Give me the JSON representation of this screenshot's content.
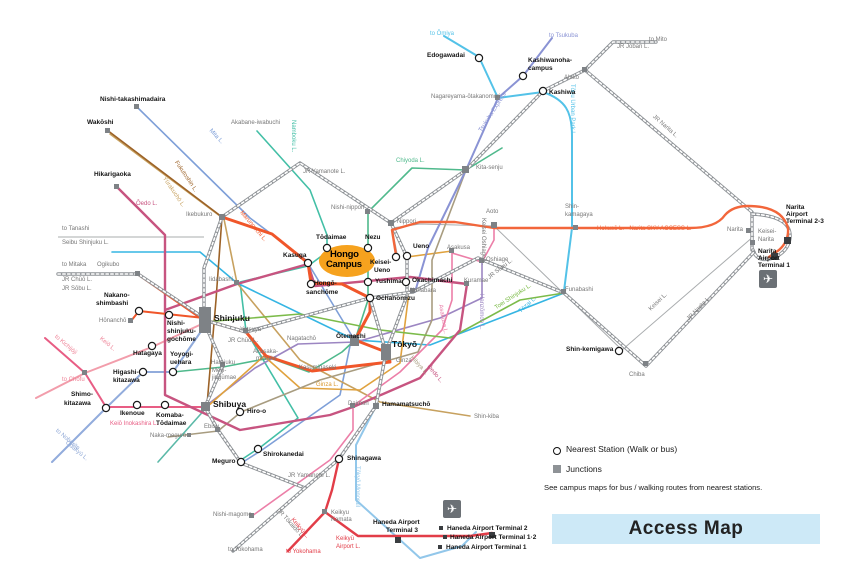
{
  "colors": {
    "jr_rail": "#8E9296",
    "marunouchi": "#F0562A",
    "ginza": "#E0A23E",
    "hibiya": "#A89C80",
    "chiyoda": "#4FB98C",
    "namboku": "#43BFA6",
    "mita": "#7E9FD8",
    "oedo": "#C75480",
    "tozai": "#35B5E3",
    "yurakucho": "#C7A15F",
    "fukutoshin": "#9C6227",
    "hanzomon": "#9C86C2",
    "asakusa_line": "#EC7FA8",
    "toei_shinjuku": "#7CBB4A",
    "keio": "#F29DAB",
    "inokashira": "#E85D84",
    "odakyu": "#92ACDC",
    "keikyu": "#E23D48",
    "monorail": "#92C7EA",
    "tobu_urban_park": "#53C2E8",
    "tsukuba_express": "#8A93D4",
    "hokuso_sky_access": "#F2663B",
    "keisei": "#A9ACAE",
    "denentoshi": "#5BB9A8",
    "campus_highlight": "#F6A21E",
    "title_bg": "#CDE9F7"
  },
  "campus": {
    "line1": "Hongo",
    "line2": "Campus"
  },
  "legend": {
    "nearest_station": "Nearest Station (Walk or bus)",
    "junctions": "Junctions",
    "note": "See campus maps for bus / walking routes from nearest stations.",
    "title": "Access Map"
  },
  "stations": {
    "wakoshi": "Wakōshi",
    "nishi_takashimadaira": "Nishi-takashimadaira",
    "hikarigaoka": "Hikarigaoka",
    "akabane_iwabuchi": "Akabane-iwabuchi",
    "edogawadai": "Edogawadai",
    "kashiwanoha_a": "Kashiwanoha-",
    "kashiwanoha_b": "campus",
    "kashiwa": "Kashiwa",
    "abiko": "Abiko",
    "nagareyama": "Nagareyama-ōtakanomori",
    "kita_senju": "Kita-senju",
    "nishi_nippori": "Nishi-nippori",
    "nippori": "Nippori",
    "ikebukuro": "Ikebukuro",
    "ogikubo": "Ogikubo",
    "yotsuya": "Yotsuya",
    "iidabashi": "Iidabashi",
    "nakano_shimbashi_a": "Nakano-",
    "nakano_shimbashi_b": "shimbashi",
    "honancho": "Hōnanchō",
    "nishi_shinjuku_a": "Nishi-",
    "nishi_shinjuku_b": "shinjuku-",
    "nishi_shinjuku_c": "gochōme",
    "shinjuku": "Shinjuku",
    "hatagaya": "Hatagaya",
    "yoyogi_a": "Yoyogi-",
    "yoyogi_b": "uehara",
    "higashi_a": "Higashi-",
    "higashi_b": "kitazawa",
    "shimo_a": "Shimo-",
    "shimo_b": "kitazawa",
    "ikenoue": "Ikenoue",
    "komaba_a": "Komaba-",
    "komaba_b": "Tōdaimae",
    "harajuku": "Harajuku",
    "meiji_a": "Meiji-",
    "meiji_b": "jingūmae",
    "shibuya": "Shibuya",
    "hiro_o": "Hiro-o",
    "ebisu": "Ebisu",
    "naka_meguro": "Naka-meguro",
    "meguro": "Meguro",
    "shirokanedai": "Shirokanedai",
    "shinagawa": "Shinagawa",
    "nishi_magome": "Nishi-magome",
    "keikyu_kamata_a": "Keikyu",
    "keikyu_kamata_b": "Kamata",
    "todaimae": "Tōdaimae",
    "nezu": "Nezu",
    "kasuga": "Kasuga",
    "hongo_sanchome_a": "Hongō-",
    "hongo_sanchome_b": "sanchōme",
    "yushima": "Yushima",
    "ochanomizu": "Ochanomizu",
    "keisei_ueno_a": "Keisei-",
    "keisei_ueno_b": "Ueno",
    "ueno": "Ueno",
    "okachimachi": "Okachimachi",
    "akihabara": "Akihabara",
    "asakusa": "Asakusa",
    "oshiage": "Oshiage",
    "kuramae": "Kuramae",
    "nagatacho": "Nagatachō",
    "akasaka_a": "Akasaka-",
    "akasaka_b": "mitsuke",
    "kasumigaseki": "Kasumigaseki",
    "otemachi": "Ōtemachi",
    "tokyo": "Tōkyō",
    "ginza": "Ginza",
    "daimon": "Daimon",
    "hamamatsucho": "Hamamatsuchō",
    "shin_kiba": "Shin-kiba",
    "aoto": "Aoto",
    "shin_kamagaya_a": "Shin-",
    "shin_kamagaya_b": "kamagaya",
    "funabashi": "Funabashi",
    "narita": "Narita",
    "keisei_narita_a": "Keisei-",
    "keisei_narita_b": "Narita",
    "shin_kemigawa": "Shin-kemigawa",
    "chiba": "Chiba"
  },
  "lines": {
    "jr_yamanote": "JR Yamanote L.",
    "jr_chuo": "JR Chūō L.",
    "jr_sobu": "JR Sōbu L.",
    "seibu_shinjuku": "Seibu Shinjuku L.",
    "jr_joban": "JR Joban L.",
    "jr_narita": "JR Narita L.",
    "jr_tokaido": "JR Tōkaidō L.",
    "mita": "Mita L.",
    "namboku": "Namboku L.",
    "chiyoda": "Chiyoda L.",
    "oedo": "Ōedo L.",
    "fukutoshin": "Fukutoshin L.",
    "yurakucho": "Yūrakuchō L.",
    "marunouchi": "Marunouchi L.",
    "tozai": "Tōzai L.",
    "ginza": "Ginza L.",
    "hibiya": "Hibiya L.",
    "hanzomon": "Hanzōmon L.",
    "asakusa": "Asakusa L.",
    "toei_shinjuku": "Toei Shinjuku L.",
    "keisei_oshiage": "Keisei Oshiage L.",
    "keisei": "Keisei L.",
    "keio": "Keiō L.",
    "keio_inokashira": "Keiō Inokashira L.",
    "odakyu": "Odakyū L.",
    "keikyu": "Keikyū L.",
    "keikyu_airport_a": "Keikyū",
    "keikyu_airport_b": "Airport L.",
    "monorail": "Tōkyō Monorail",
    "tobu": "Tōbu Urban Park L.",
    "tx": "Tsukuba Express",
    "hokuso": "Hokusō L. · Narita SKY ACCESS L."
  },
  "directions": {
    "omiya": "to Ōmiya",
    "tsukuba": "to Tsukuba",
    "mito": "to Mito",
    "tanashi": "to Tanashi",
    "mitaka": "to Mitaka",
    "kichijoji": "to Kichijōji",
    "chofu": "to Chōfu",
    "noborito": "to Noborito",
    "yokohama_jr": "to Yokohama",
    "yokohama_keikyu": "to Yokohama"
  },
  "airports": {
    "haneda_t3_a": "Haneda Airport",
    "haneda_t3_b": "Terminal 3",
    "haneda_t2": "Haneda Airport Terminal 2",
    "haneda_t12": "Haneda Airport Terminal 1·2",
    "haneda_t1": "Haneda Airport Terminal 1",
    "narita_a": "Narita",
    "narita_b": "Airport",
    "narita_t23_c": "Terminal 2-3",
    "narita_t1_c": "Terminal 1",
    "airplane_icon": "airplane-icon"
  }
}
